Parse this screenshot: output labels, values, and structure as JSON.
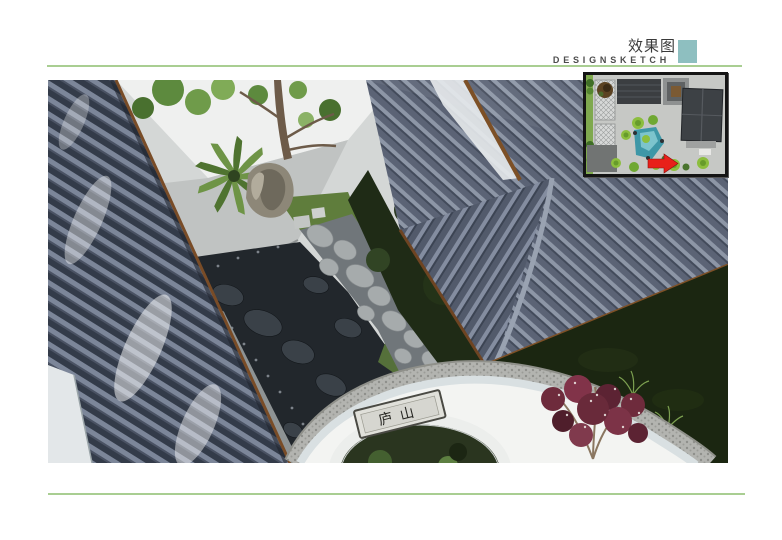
{
  "header": {
    "title": "效果图",
    "subtitle": "DESIGNSKETCH"
  },
  "rendering": {
    "caption": "aerial courtyard rendering",
    "plaque_text": "庐山"
  },
  "inset": {
    "caption": "site plan locator"
  },
  "colors": {
    "accent_teal": "#8ebfc0",
    "divider_green": "#a9ce92",
    "arrow_red": "#e8201a",
    "roof_dark": "#333b49",
    "roof_light": "#7c8699",
    "pond_slate": "#22272c",
    "wall_white": "#f3f4f2",
    "lawn_green": "#1b2611"
  }
}
